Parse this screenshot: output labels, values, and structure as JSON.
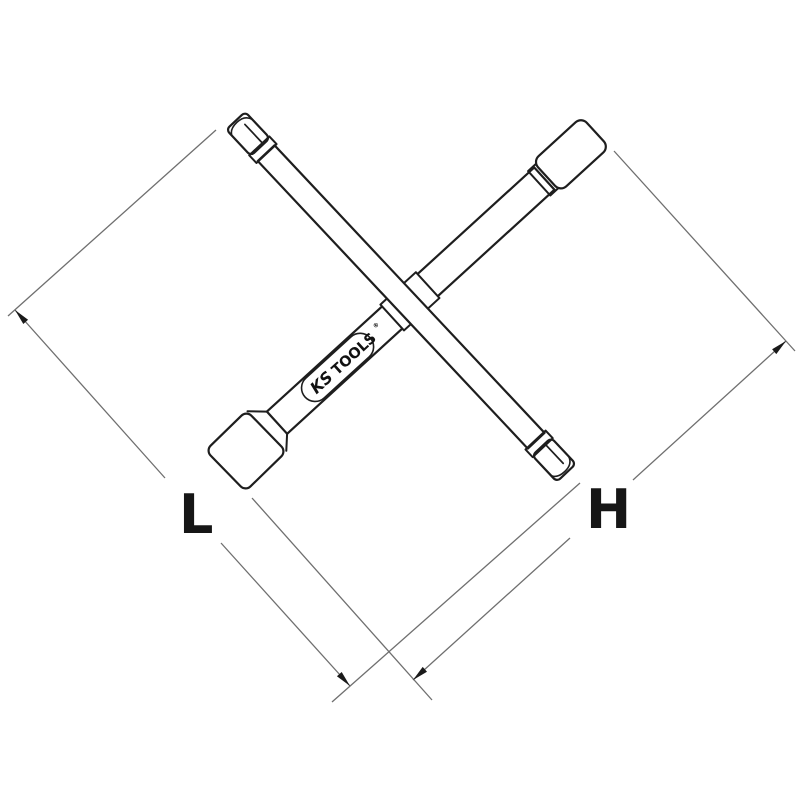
{
  "page": {
    "background_color": "#ffffff"
  },
  "drawing": {
    "type": "technical-line-drawing",
    "subject": "4-way cross wrench with square drive, socket end and two hex tips",
    "outline_color": "#1e1e1e",
    "dimension_line_color": "#6f6f6f",
    "arrowhead_color": "#1a1a1a"
  },
  "dimensions": {
    "left_label": "L",
    "right_label": "H"
  },
  "logo": {
    "prefix": "KS",
    "suffix": "TOOLS",
    "registered": "®"
  }
}
